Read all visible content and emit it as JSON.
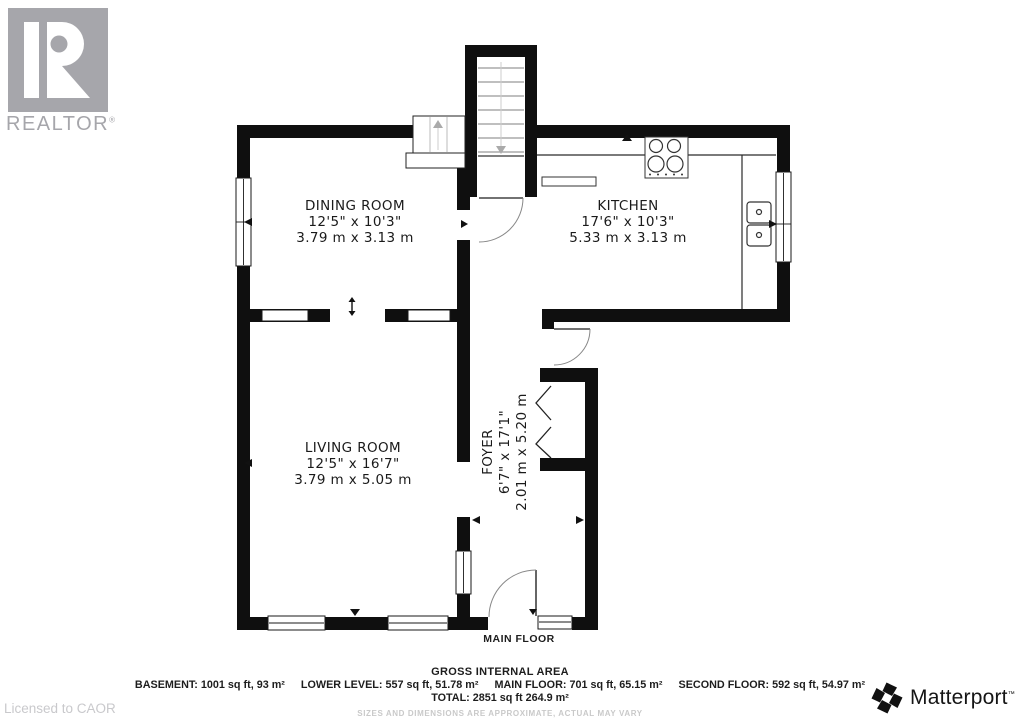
{
  "branding": {
    "realtor_wordmark": "REALTOR",
    "registered_mark": "®",
    "licensed_note": "Licensed to CAOR",
    "matterport_wordmark": "Matterport",
    "trademark_mark": "™"
  },
  "rooms": [
    {
      "name": "DINING ROOM",
      "imperial": "12'5\" x 10'3\"",
      "metric": "3.79 m x 3.13 m"
    },
    {
      "name": "KITCHEN",
      "imperial": "17'6\" x 10'3\"",
      "metric": "5.33 m x 3.13 m"
    },
    {
      "name": "LIVING ROOM",
      "imperial": "12'5\" x 16'7\"",
      "metric": "3.79 m x 5.05 m"
    },
    {
      "name": "FOYER",
      "imperial": "6'7\" x 17'1\"",
      "metric": "2.01 m x 5.20 m"
    }
  ],
  "floor_label": "MAIN FLOOR",
  "area_summary": {
    "title": "GROSS INTERNAL AREA",
    "segments": [
      "BASEMENT: 1001 sq ft, 93 m²",
      "LOWER LEVEL: 557 sq ft, 51.78 m²",
      "MAIN FLOOR: 701 sq ft, 65.15 m²",
      "SECOND FLOOR: 592 sq ft, 54.97 m²"
    ],
    "total": "TOTAL: 2851 sq ft 264.9 m²",
    "disclaimer": "SIZES AND DIMENSIONS ARE APPROXIMATE, ACTUAL MAY VARY"
  },
  "colors": {
    "wall": "#0f0f0f",
    "logo-gray": "#a6a6ab",
    "muted-text": "#c9c9cc",
    "ink": "#1a1a1a"
  }
}
